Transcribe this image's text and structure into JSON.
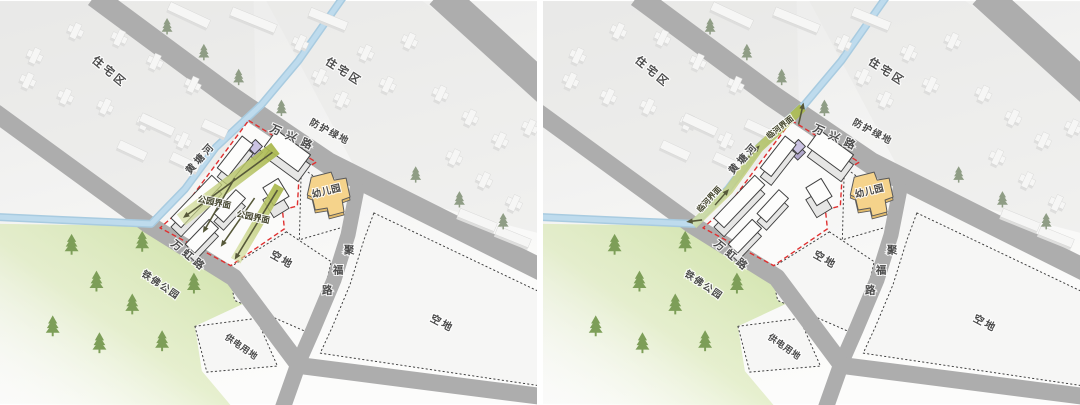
{
  "figure": {
    "title": "site interface analysis diagram pair",
    "panels": [
      {
        "name": "site-plan-park-interface",
        "variant": "park_interface"
      },
      {
        "name": "site-plan-river-interface",
        "variant": "river_interface"
      }
    ]
  },
  "base_labels": [
    {
      "id": "residential-nw",
      "text": "住宅区",
      "x": 108,
      "y": 74,
      "rot": 40,
      "size": 11,
      "ls": 3
    },
    {
      "id": "residential-ne",
      "text": "住宅区",
      "x": 344,
      "y": 74,
      "rot": 33,
      "size": 11,
      "ls": 3
    },
    {
      "id": "green-buffer",
      "text": "防护绿地",
      "x": 330,
      "y": 134,
      "rot": 28,
      "size": 9.5,
      "ls": 1.5
    },
    {
      "id": "road-wanxing",
      "text": "万兴路",
      "x": 294,
      "y": 141,
      "rot": 24,
      "size": 11,
      "ls": 6
    },
    {
      "id": "river-huangtang",
      "text": "黄塘河",
      "x": 204,
      "y": 160,
      "rot": -48,
      "size": 10,
      "ls": 3
    },
    {
      "id": "kindergarten",
      "text": "幼儿园",
      "x": 329,
      "y": 194,
      "rot": -14,
      "size": 9.5,
      "ls": 0.5
    },
    {
      "id": "road-jufu",
      "text": "聚福路",
      "size": 10.5,
      "chars": [
        [
          351,
          254
        ],
        [
          340,
          274
        ],
        [
          329,
          294
        ]
      ]
    },
    {
      "id": "vacant-mid",
      "text": "空地",
      "x": 282,
      "y": 263,
      "rot": 30,
      "size": 10.5,
      "ls": 2
    },
    {
      "id": "vacant-east",
      "text": "空地",
      "x": 443,
      "y": 327,
      "rot": 28,
      "size": 10.5,
      "ls": 2
    },
    {
      "id": "road-wanhong",
      "text": "万虹路",
      "x": 188,
      "y": 259,
      "rot": 40,
      "size": 10.5,
      "ls": 4
    },
    {
      "id": "park-tiefo",
      "text": "铁佛公园",
      "x": 160,
      "y": 288,
      "rot": 34,
      "size": 9.5,
      "ls": 1.5
    },
    {
      "id": "power-land",
      "text": "供电用地",
      "x": 241,
      "y": 350,
      "rot": 35,
      "size": 9,
      "ls": 0.5
    }
  ],
  "variant_labels": {
    "park_interface": [
      {
        "id": "interface-park-1",
        "text": "公园界面",
        "x": 215,
        "y": 205,
        "rot": 12,
        "size": 8.5,
        "color": "#45462f"
      },
      {
        "id": "interface-park-2",
        "text": "公园界面",
        "x": 254,
        "y": 220,
        "rot": 12,
        "size": 8.5,
        "color": "#45462f"
      }
    ],
    "river_interface": [
      {
        "id": "interface-river-1",
        "text": "临河界面",
        "x": 240,
        "y": 129,
        "rot": -38,
        "size": 8,
        "color": "#45462f"
      },
      {
        "id": "interface-river-2",
        "text": "临河界面",
        "x": 169,
        "y": 201,
        "rot": -48,
        "size": 8,
        "color": "#45462f"
      }
    ]
  },
  "colors": {
    "road": "#adadad",
    "river_outer": "#a8cbe0",
    "river_inner": "#bedbed",
    "park_green": "#c9df9d",
    "band_olive": "#aab84e",
    "band_olive_light": "#d3de9b",
    "arrow_dark": "#565839",
    "kindergarten_fill": "#f5d38b",
    "kindergarten_side": "#e0ba6c",
    "purple_annex": "#cbc3e3",
    "building_top": "#fdfdfc",
    "building_side": "#e6e6e5",
    "building_stroke": "#3f3f3f",
    "bg_block_top": "#f6f6f5",
    "bg_block_side": "#dededd",
    "red_boundary": "#e03030",
    "dotted_line": "#404040",
    "tree_road": "#8f9d85",
    "tree_park": "#7d9e58",
    "label_text": "#4a4a4a",
    "ground_wash": "#e7e7e6",
    "parcel_fill": "#f6f6f5",
    "site_ground": "#fbfbfa"
  }
}
